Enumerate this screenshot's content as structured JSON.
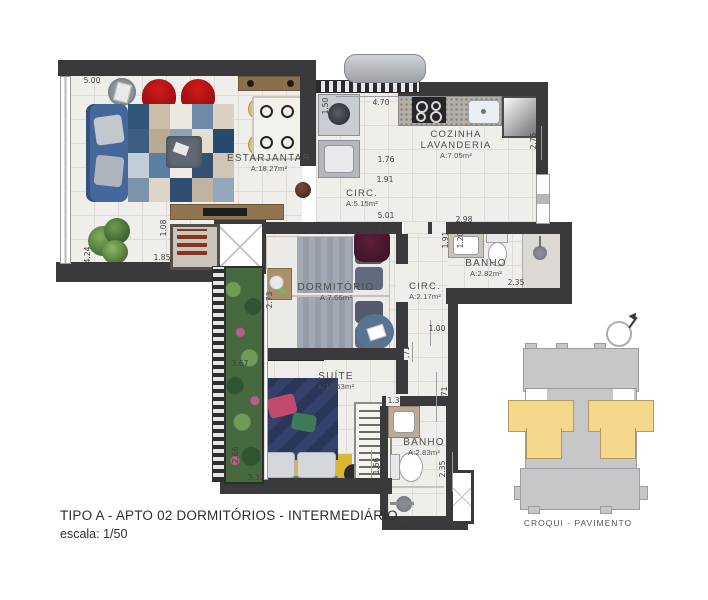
{
  "title": {
    "line1": "TIPO A - APTO 02  DORMITÓRIOS - INTERMEDIÁRIO",
    "line2": "escala: 1/50"
  },
  "croqui": {
    "label": "CROQUI - PAVIMENTO"
  },
  "rooms": [
    {
      "name": "ESTARJANTAR",
      "area": "A:18.27m²"
    },
    {
      "name": "COZINHA",
      "name2": "LAVANDERIA",
      "area": "A:7.05m²"
    },
    {
      "name": "CIRC.",
      "area": "A:5.15m²"
    },
    {
      "name": "DORMITÓRIO",
      "area": "A:7.66m²"
    },
    {
      "name": "CIRC.",
      "area": "A:2.17m²"
    },
    {
      "name": "BANHO",
      "area": "A:2.82m²"
    },
    {
      "name": "SUÍTE",
      "area": "A:10.63m²"
    },
    {
      "name": "BANHO",
      "area": "A:2.83m²"
    }
  ],
  "dimensions": [
    "5.00",
    "2.15",
    "1.50",
    "4.70",
    "2.75",
    "1.76",
    "1.91",
    "5.01",
    "2.98",
    "1.91",
    "1.20",
    "2.81",
    "2.35",
    "1.08",
    "1.85",
    "4.24",
    "2.73",
    "1.00",
    ".71",
    "1.71",
    "3.67",
    "2.66",
    "3.32",
    "1.66",
    "1.35",
    "2.35",
    "1.20"
  ],
  "colors": {
    "wall": "#3a3a3c",
    "floor": "#f0eeea",
    "croqui_gray": "#c7c7ca",
    "croqui_yellow": "#f6d88c",
    "sofa_blue": "#46679c",
    "chair_red": "#b51414",
    "suite_rug_yellow": "#d7b733",
    "bed_navy": "#33416b"
  }
}
